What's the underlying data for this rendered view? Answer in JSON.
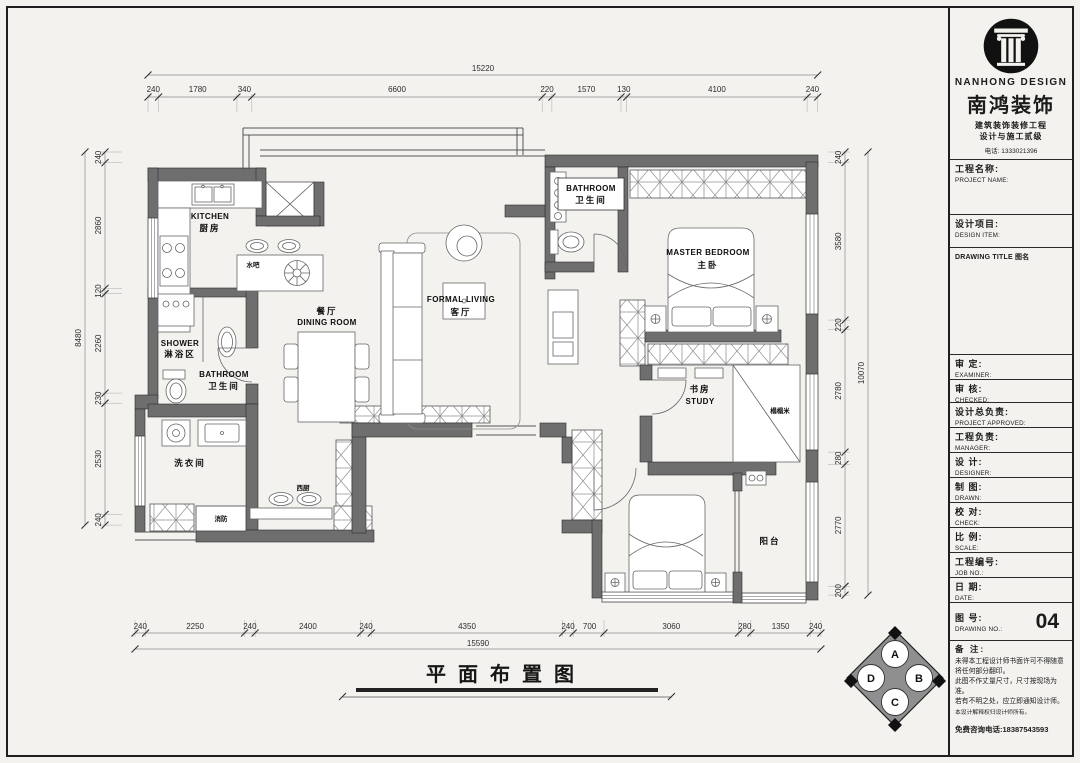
{
  "plan": {
    "title": "平面布置图"
  },
  "dims": {
    "top": {
      "total": "15220",
      "segments": [
        "240",
        "1780",
        "340",
        "6600",
        "220",
        "1570",
        "130",
        "4100",
        "240"
      ]
    },
    "bottom": {
      "total": "15590",
      "segments": [
        "240",
        "2250",
        "240",
        "2400",
        "240",
        "4350",
        "240",
        "700",
        "3060",
        "280",
        "1350",
        "240"
      ]
    },
    "left": {
      "total": "8480",
      "segments": [
        "240",
        "2860",
        "120",
        "2260",
        "230",
        "2530",
        "240"
      ]
    },
    "right": {
      "total": "10070",
      "segments": [
        "240",
        "3580",
        "220",
        "2780",
        "280",
        "2770",
        "200"
      ]
    }
  },
  "rooms": {
    "kitchen": {
      "en": "KITCHEN",
      "zh": "厨房"
    },
    "dining": {
      "zh": "餐厅",
      "en": "DINING ROOM"
    },
    "living": {
      "en": "FORMAL LIVING",
      "zh": "客厅"
    },
    "master_bath": {
      "en": "BATHROOM",
      "zh": "卫生间"
    },
    "master_bedroom": {
      "en": "MASTER BEDROOM",
      "zh": "主卧"
    },
    "study": {
      "zh": "书房",
      "en": "STUDY"
    },
    "shower": {
      "en": "SHOWER",
      "zh": "淋浴区"
    },
    "bath2": {
      "en": "BATHROOM",
      "zh": "卫生间"
    },
    "laundry": {
      "zh": "洗衣间"
    },
    "balcony": {
      "zh": "阳台"
    },
    "bar": {
      "zh": "水吧"
    },
    "west_kitchen": {
      "zh": "西厨"
    },
    "fire": {
      "zh": "消防"
    },
    "tatami": {
      "zh": "榻榻米"
    }
  },
  "compass": {
    "a": "A",
    "b": "B",
    "c": "C",
    "d": "D"
  },
  "tb": {
    "logo_en": "NANHONG DESIGN",
    "logo_zh": "南鸿装饰",
    "tagline1": "建筑装饰装修工程",
    "tagline2": "设计与施工贰级",
    "phone": "电话: 1333021396",
    "fields": [
      {
        "zh": "工程名称:",
        "en": "PROJECT NAME:"
      },
      {
        "zh": "设计项目:",
        "en": "DESIGN ITEM:"
      },
      {
        "zh": "审  定:",
        "en": "EXAMINER:"
      },
      {
        "zh": "审  核:",
        "en": "CHECKED:"
      },
      {
        "zh": "设计总负责:",
        "en": "PROJECT APPROVED:"
      },
      {
        "zh": "工程负责:",
        "en": "MANAGER:"
      },
      {
        "zh": "设  计:",
        "en": "DESIGNER:"
      },
      {
        "zh": "制  图:",
        "en": "DRAWN:"
      },
      {
        "zh": "校  对:",
        "en": "CHECK:"
      },
      {
        "zh": "比  例:",
        "en": "SCALE:"
      },
      {
        "zh": "工程编号:",
        "en": "JOB  NO.:"
      },
      {
        "zh": "日  期:",
        "en": "DATE:"
      }
    ],
    "drawing_title": {
      "en": "DRAWING TITLE",
      "zh": "图名"
    },
    "drawing_no": {
      "zh": "图  号:",
      "en": "DRAWING NO.:",
      "value": "04"
    },
    "notes_label": "备  注:",
    "notes": [
      "未得本工程设计师书面许可不得随意将任何部分翻印。",
      "此图不作丈量尺寸，尺寸按现场为准。",
      "若有不明之处，应立即通知设计师。",
      "本设计解释权归设计师所有。"
    ],
    "hotline": "免费咨询电话:18387543593"
  }
}
